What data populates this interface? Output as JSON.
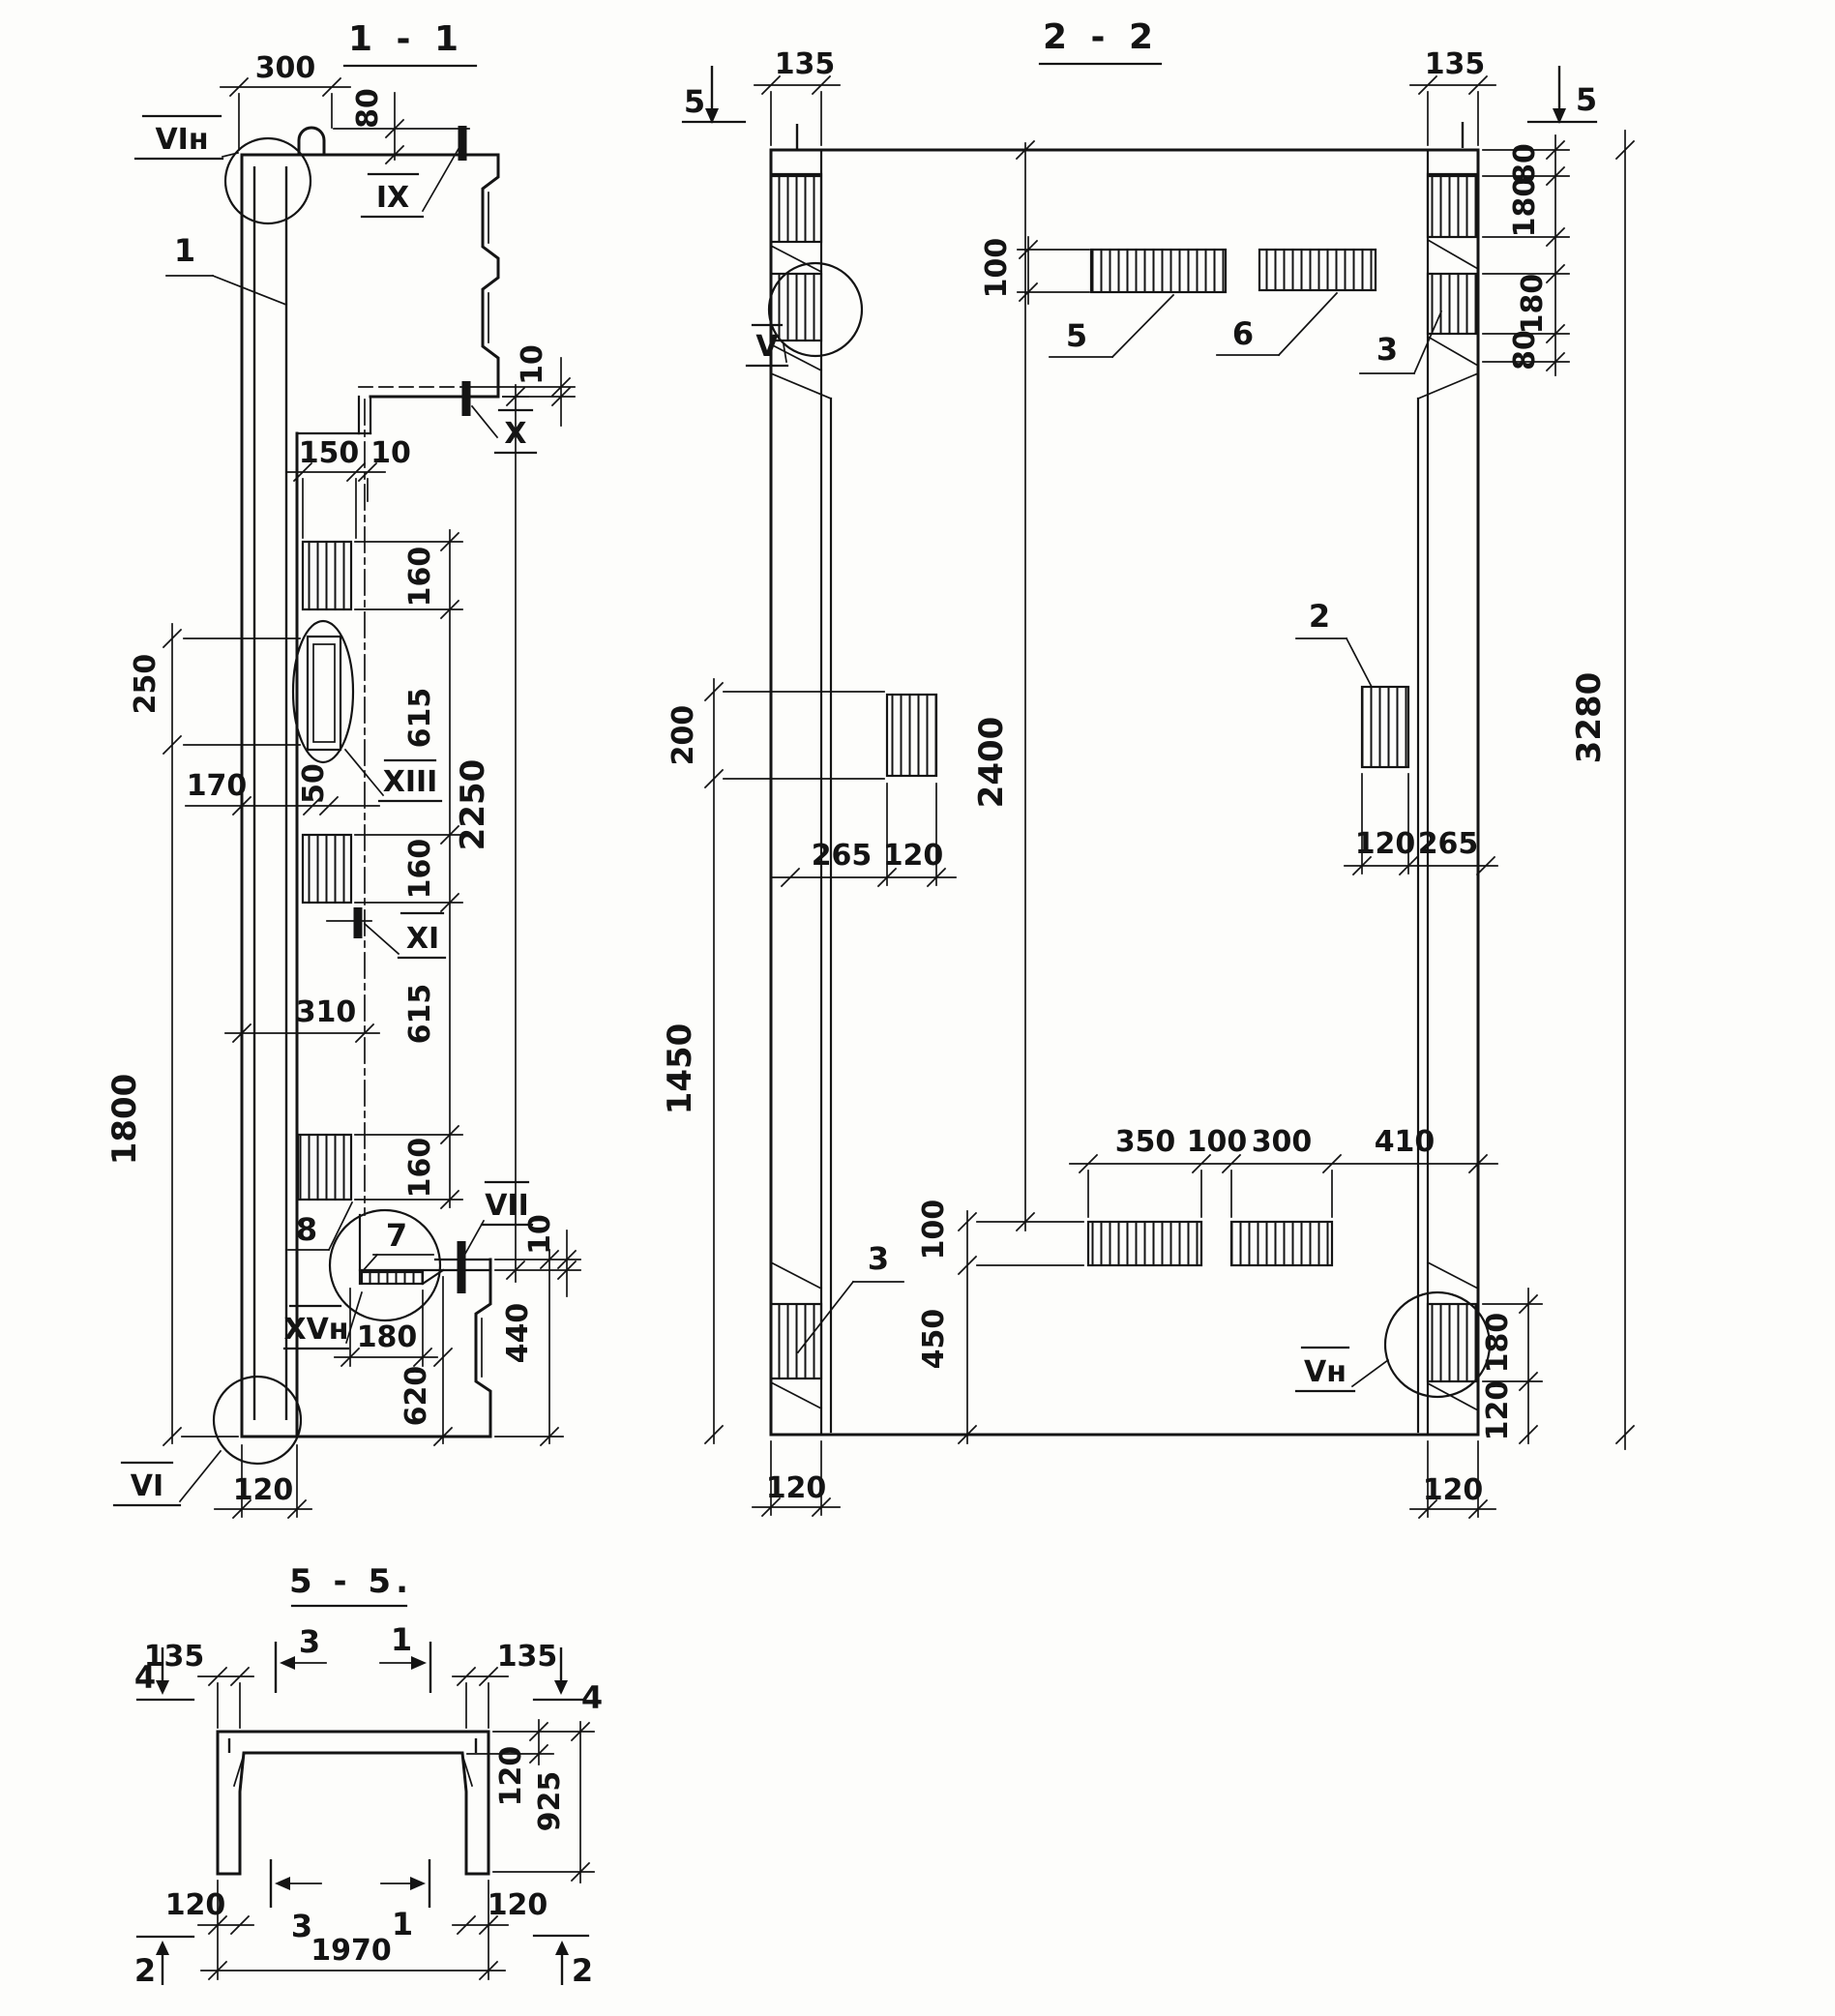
{
  "s11": {
    "title": "1 - 1",
    "dims": {
      "d300": "300",
      "d80": "80",
      "d10a": "10",
      "d150": "150",
      "d10b": "10",
      "d160a": "160",
      "d615a": "615",
      "d50": "50",
      "d170": "170",
      "d250": "250",
      "d160b": "160",
      "d615b": "615",
      "d310": "310",
      "d1800": "1800",
      "d2250": "2250",
      "d160c": "160",
      "d180": "180",
      "d620": "620",
      "d440": "440",
      "d10c": "10",
      "d120": "120"
    },
    "marks": {
      "vih": "VIн",
      "ix": "IX",
      "x": "X",
      "xiii": "XIII",
      "xi": "XI",
      "vii": "VII",
      "xvh": "XVн",
      "vi": "VI"
    },
    "labels": {
      "l1": "1",
      "l7": "7",
      "l8": "8"
    }
  },
  "s22": {
    "title": "2 - 2",
    "dims": {
      "d135l": "135",
      "d135r": "135",
      "d80a": "80",
      "d180a": "180",
      "d180b": "180",
      "d80b": "80",
      "d3280": "3280",
      "d100a": "100",
      "d200": "200",
      "d2400": "2400",
      "d265a": "265",
      "d120a": "120",
      "d120b": "120",
      "d265b": "265",
      "d1450": "1450",
      "d350": "350",
      "d100b": "100",
      "d300": "300",
      "d410": "410",
      "d100c": "100",
      "d450": "450",
      "d180c": "180",
      "d120c": "120",
      "d120d": "120",
      "d120e": "120"
    },
    "marks": {
      "v": "V",
      "vn": "Vн",
      "c5l": "5",
      "c5r": "5"
    },
    "labels": {
      "p5": "5",
      "p6": "6",
      "p3a": "3",
      "p2": "2",
      "p3b": "3"
    }
  },
  "s55": {
    "title": "5 - 5.",
    "dims": {
      "d135l": "135",
      "d135r": "135",
      "d120a": "120",
      "d925": "925",
      "d120b": "120",
      "d120c": "120",
      "d1970": "1970"
    },
    "marks": {
      "c4l": "4",
      "c4r": "4",
      "c3t": "3",
      "c1t": "1",
      "c3b": "3",
      "c1b": "1",
      "c2l": "2",
      "c2r": "2"
    }
  }
}
